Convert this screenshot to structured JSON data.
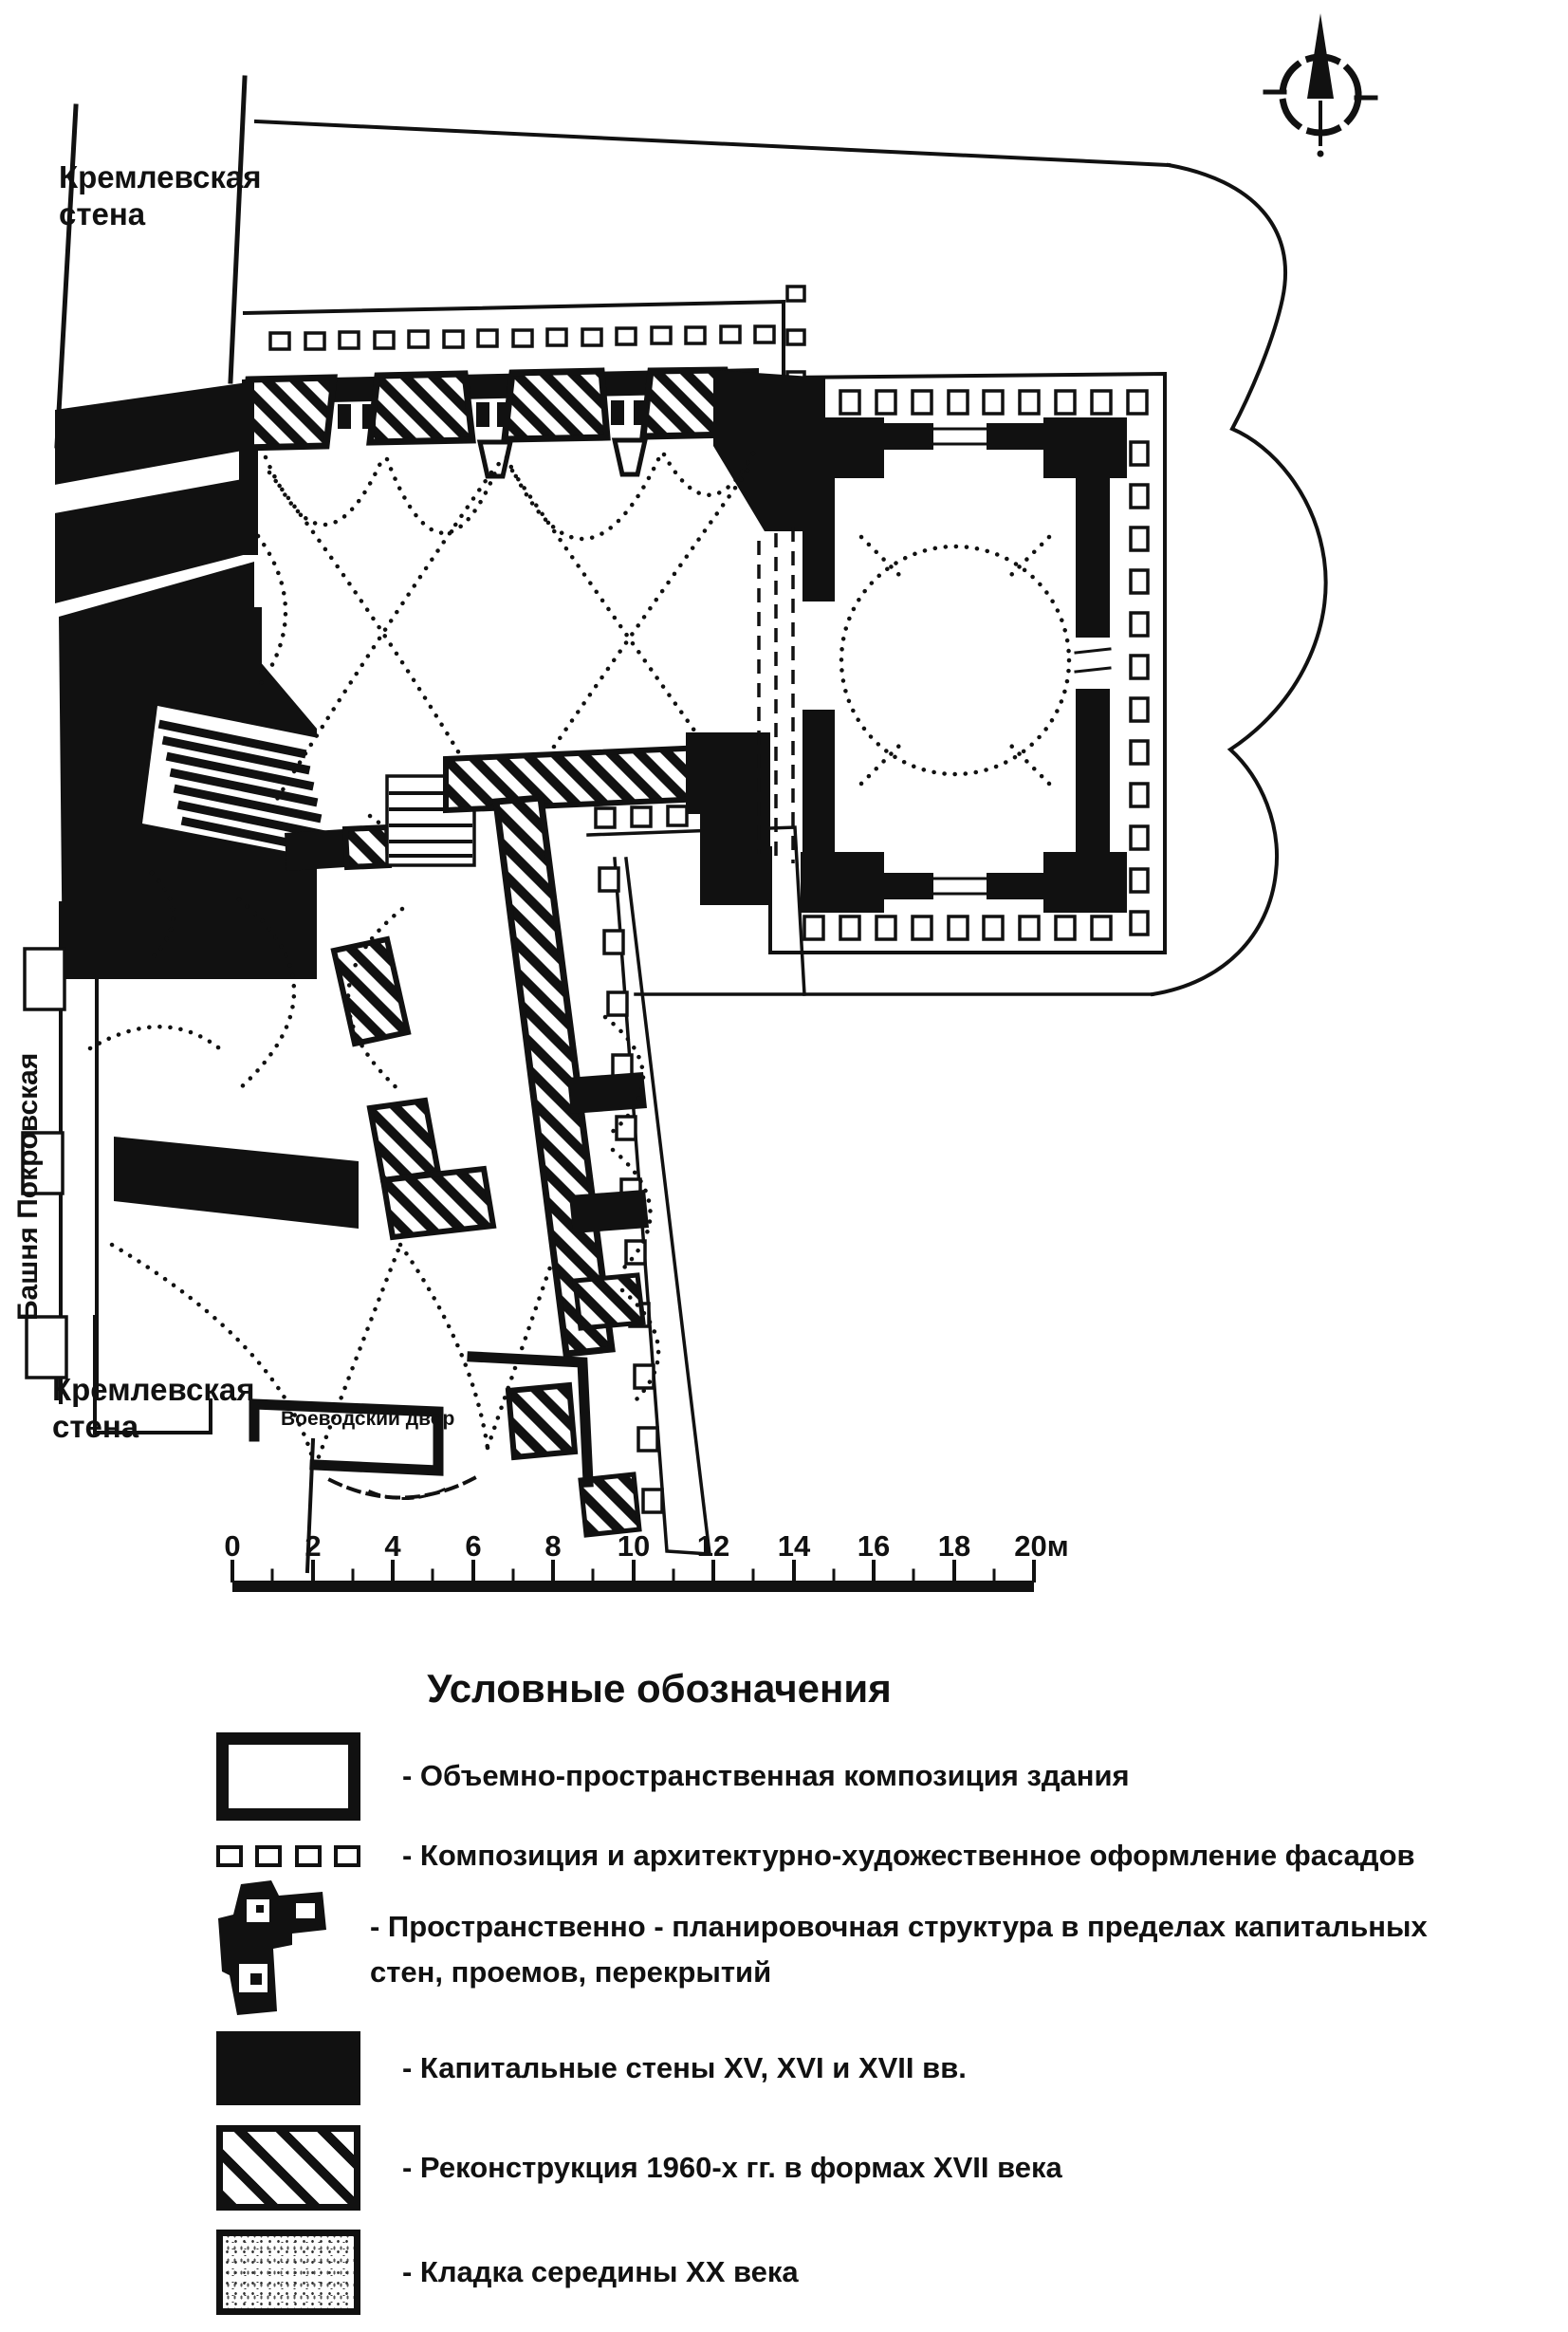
{
  "plan": {
    "labels": {
      "kremlin_wall_top": "Кремлевская стена",
      "kremlin_wall_bottom": "Кремлевская стена",
      "tower_vertical": "Башня Покровская",
      "courtyard": "Воеводский двор"
    },
    "scale_bar": {
      "tick_labels": [
        "0",
        "2",
        "4",
        "6",
        "8",
        "10",
        "12",
        "14",
        "16",
        "18",
        "20м"
      ],
      "unit": "м",
      "range_m": [
        0,
        20
      ]
    },
    "icons": {
      "compass": "north-arrow-icon"
    },
    "colors": {
      "ink": "#111111",
      "paper": "#ffffff"
    }
  },
  "legend": {
    "title": "Условные обозначения",
    "items": [
      {
        "swatch": "outline-rect",
        "label": "- Объемно-пространственная композиция здания"
      },
      {
        "swatch": "facade-squares",
        "label": "- Композиция и архитектурно-художественное оформление фасадов"
      },
      {
        "swatch": "plan-fragment",
        "label": "- Пространственно - планировочная структура в пределах капитальных стен, проемов, перекрытий"
      },
      {
        "swatch": "solid-black",
        "label": "- Капитальные стены XV, XVI и XVII вв."
      },
      {
        "swatch": "diagonal-hatch",
        "label": "- Реконструкция 1960-х гг. в формах XVII века"
      },
      {
        "swatch": "stipple",
        "label": "- Кладка середины XX века"
      }
    ]
  }
}
